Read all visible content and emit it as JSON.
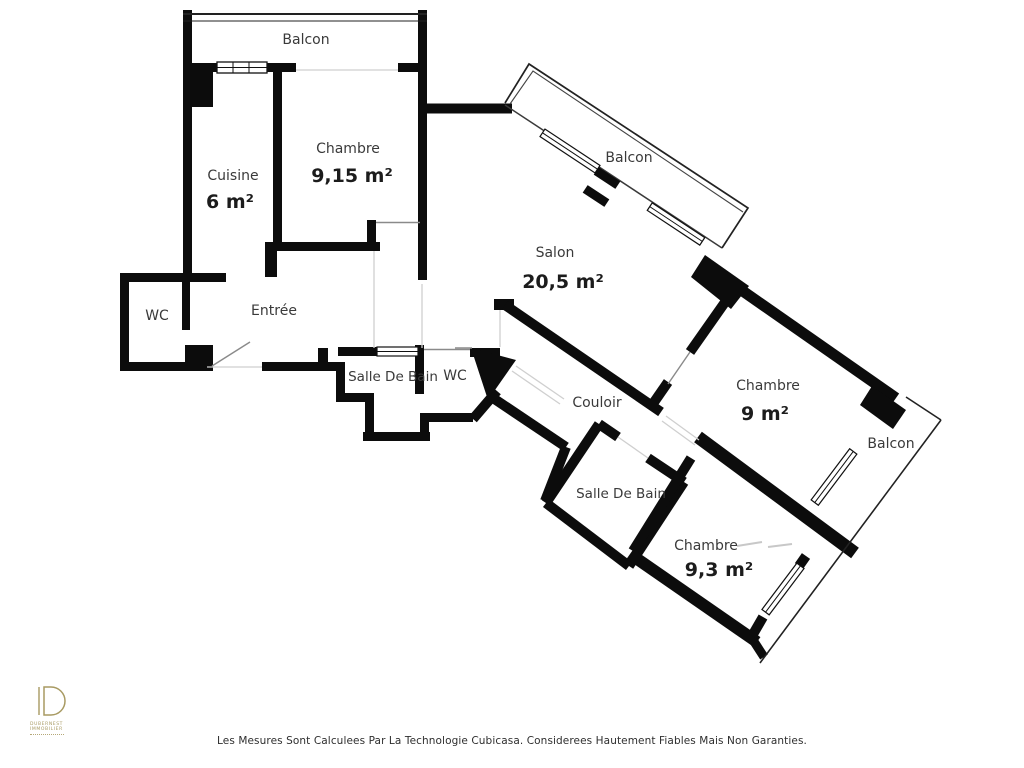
{
  "page": {
    "background": "#ffffff"
  },
  "rooms": {
    "balcon_tl": {
      "label": "Balcon"
    },
    "cuisine": {
      "label": "Cuisine",
      "area": "6 m²"
    },
    "chambre1": {
      "label": "Chambre",
      "area": "9,15 m²"
    },
    "balcon_tr": {
      "label": "Balcon"
    },
    "salon": {
      "label": "Salon",
      "area": "20,5 m²"
    },
    "wc1": {
      "label": "WC"
    },
    "entree": {
      "label": "Entrée"
    },
    "sdb1": {
      "label": "Salle De Bain"
    },
    "wc2": {
      "label": "WC"
    },
    "couloir": {
      "label": "Couloir"
    },
    "chambre2": {
      "label": "Chambre",
      "area": "9 m²"
    },
    "balcon_r": {
      "label": "Balcon"
    },
    "sdb2": {
      "label": "Salle De Bain"
    },
    "chambre3": {
      "label": "Chambre",
      "area": "9,3 m²"
    }
  },
  "footer": {
    "disclaimer": "Les Mesures Sont Calculees Par La Technologie Cubicasa. Considerees Hautement Fiables Mais Non Garanties."
  },
  "logo": {
    "initial": "D",
    "line1": "DUBERNEST",
    "line2": "IMMOBILIER"
  },
  "colors": {
    "wall": "#0c0c0c",
    "room_label": "#3a3a3a",
    "area_label": "#1c1c1c",
    "thin_line": "#2e2e2e",
    "opening_line": "#cfcfcf",
    "logo_gold": "#a89a62",
    "watermark": "#c8c8c8"
  }
}
